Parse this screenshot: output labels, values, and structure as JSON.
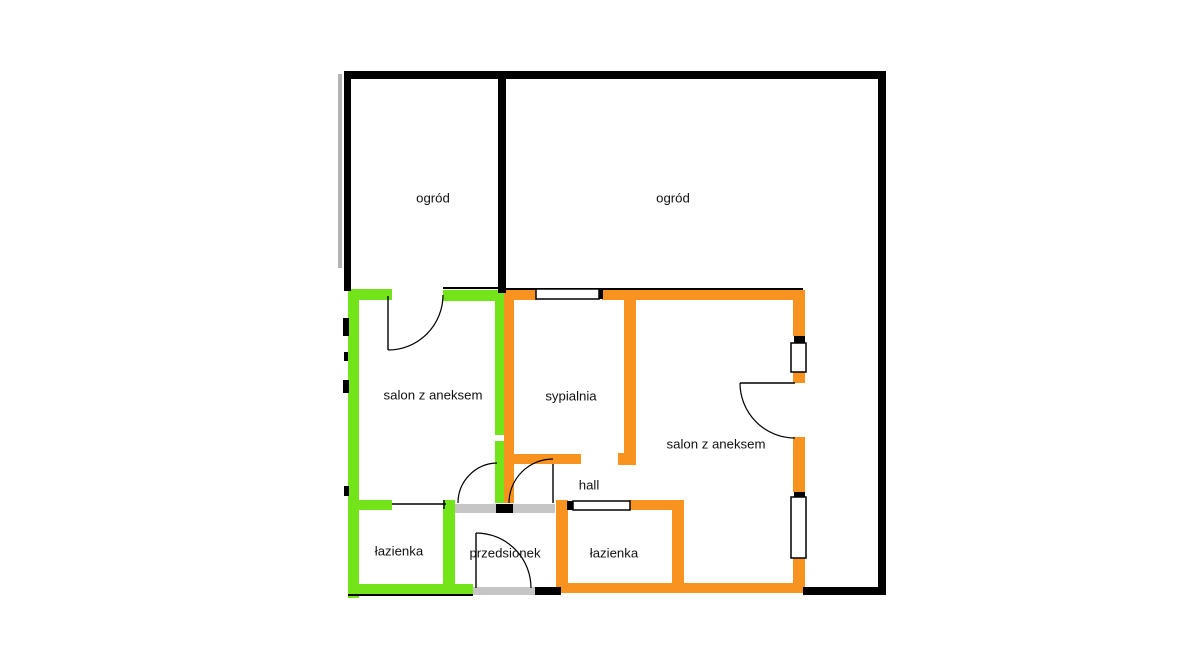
{
  "page": {
    "title": "Floor plan of two apartments with gardens",
    "background": "#ffffff"
  },
  "plan": {
    "width": 1191,
    "height": 667,
    "colors": {
      "black": "#000000",
      "green": "#74e41a",
      "orange": "#f7931e",
      "gray": "#c6c6c6",
      "shadow": "#b3b3b3",
      "window_fill": "#ffffff",
      "line": "#000000",
      "label": "#111111"
    },
    "label_font_size": 13.2,
    "shadows": [
      {
        "name": "left-outer-shadow",
        "x": 338,
        "y": 74,
        "w": 4,
        "h": 194
      }
    ],
    "walls_gray": [
      {
        "name": "entry-top-wall",
        "x": 455,
        "y": 504,
        "w": 100,
        "h": 9
      },
      {
        "name": "entry-bottom-threshold",
        "x": 473,
        "y": 587,
        "w": 62,
        "h": 8
      }
    ],
    "walls_green": [
      {
        "name": "green-left-wall",
        "x": 348,
        "y": 289,
        "w": 11,
        "h": 309
      },
      {
        "name": "green-top-wall-1",
        "x": 348,
        "y": 289,
        "w": 44,
        "h": 11
      },
      {
        "name": "green-top-wall-2",
        "x": 443,
        "y": 290,
        "w": 58,
        "h": 11
      },
      {
        "name": "green-salon-right-wall-upper",
        "x": 495,
        "y": 291,
        "w": 10,
        "h": 144
      },
      {
        "name": "green-salon-right-wall-lower",
        "x": 495,
        "y": 441,
        "w": 10,
        "h": 62
      },
      {
        "name": "green-bathroom-top-wall",
        "x": 348,
        "y": 500,
        "w": 44,
        "h": 10
      },
      {
        "name": "green-bathroom-right-wall",
        "x": 443,
        "y": 500,
        "w": 12,
        "h": 93
      },
      {
        "name": "green-bottom-wall",
        "x": 348,
        "y": 584,
        "w": 125,
        "h": 10
      }
    ],
    "walls_orange": [
      {
        "name": "orange-bedroom-left-wall",
        "x": 504,
        "y": 291,
        "w": 10,
        "h": 212
      },
      {
        "name": "orange-top-wall-1",
        "x": 504,
        "y": 290,
        "w": 33,
        "h": 10
      },
      {
        "name": "orange-top-wall-2",
        "x": 602,
        "y": 290,
        "w": 203,
        "h": 10
      },
      {
        "name": "orange-right-wall-1",
        "x": 793,
        "y": 291,
        "w": 12,
        "h": 45
      },
      {
        "name": "orange-right-wall-2",
        "x": 793,
        "y": 372,
        "w": 12,
        "h": 11
      },
      {
        "name": "orange-right-wall-3",
        "x": 793,
        "y": 437,
        "w": 12,
        "h": 55
      },
      {
        "name": "orange-right-wall-4",
        "x": 793,
        "y": 558,
        "w": 12,
        "h": 35
      },
      {
        "name": "orange-bottom-wall",
        "x": 557,
        "y": 583,
        "w": 246,
        "h": 10
      },
      {
        "name": "orange-bedroom-right-wall",
        "x": 624,
        "y": 291,
        "w": 12,
        "h": 174
      },
      {
        "name": "orange-bedroom-right-wall-foot",
        "x": 618,
        "y": 453,
        "w": 18,
        "h": 12
      },
      {
        "name": "orange-bedroom-bottom-wall",
        "x": 504,
        "y": 454,
        "w": 77,
        "h": 10
      },
      {
        "name": "orange-bathroom-left-wall",
        "x": 556,
        "y": 500,
        "w": 12,
        "h": 93
      },
      {
        "name": "orange-bathroom-top-wall",
        "x": 628,
        "y": 500,
        "w": 56,
        "h": 10
      },
      {
        "name": "orange-bathroom-right-wall",
        "x": 672,
        "y": 500,
        "w": 12,
        "h": 90
      }
    ],
    "walls_black": [
      {
        "name": "outer-top-wall",
        "x": 345,
        "y": 71,
        "w": 541,
        "h": 8
      },
      {
        "name": "outer-left-wall",
        "x": 344,
        "y": 71,
        "w": 7,
        "h": 220
      },
      {
        "name": "outer-right-wall",
        "x": 878,
        "y": 71,
        "w": 8,
        "h": 524
      },
      {
        "name": "outer-bottom-right-wall",
        "x": 803,
        "y": 587,
        "w": 83,
        "h": 8
      },
      {
        "name": "garden-divider-wall",
        "x": 498,
        "y": 71,
        "w": 8,
        "h": 222
      },
      {
        "name": "left-wall-tick-1",
        "x": 343,
        "y": 318,
        "w": 6,
        "h": 18
      },
      {
        "name": "left-wall-tick-2",
        "x": 344,
        "y": 352,
        "w": 4,
        "h": 9
      },
      {
        "name": "left-wall-tick-3",
        "x": 343,
        "y": 380,
        "w": 6,
        "h": 13
      },
      {
        "name": "left-wall-tick-4",
        "x": 344,
        "y": 486,
        "w": 5,
        "h": 10
      },
      {
        "name": "entry-wall-stub-top",
        "x": 496,
        "y": 504,
        "w": 17,
        "h": 9
      },
      {
        "name": "entry-wall-stub-bottom",
        "x": 535,
        "y": 587,
        "w": 26,
        "h": 8
      },
      {
        "name": "window-tick-bedroom",
        "x": 598,
        "y": 290,
        "w": 5,
        "h": 9
      },
      {
        "name": "window-tick-hall",
        "x": 567,
        "y": 501,
        "w": 7,
        "h": 9
      },
      {
        "name": "window-tick-right-1",
        "x": 794,
        "y": 336,
        "w": 11,
        "h": 7
      },
      {
        "name": "window-tick-right-2",
        "x": 794,
        "y": 492,
        "w": 11,
        "h": 5
      },
      {
        "name": "wall-underlay-line-top",
        "x": 506,
        "y": 288,
        "w": 297,
        "h": 2
      },
      {
        "name": "wall-underlay-line-green-top",
        "x": 443,
        "y": 287,
        "w": 57,
        "h": 2
      },
      {
        "name": "wall-underlay-line-green-bottom",
        "x": 348,
        "y": 594,
        "w": 125,
        "h": 2
      }
    ],
    "windows": [
      {
        "name": "window-bedroom-top",
        "x": 536,
        "y": 289,
        "w": 63,
        "h": 10
      },
      {
        "name": "window-right-upper",
        "x": 791,
        "y": 343,
        "w": 15,
        "h": 29
      },
      {
        "name": "window-right-lower",
        "x": 791,
        "y": 497,
        "w": 15,
        "h": 61
      },
      {
        "name": "window-hall",
        "x": 573,
        "y": 501,
        "w": 57,
        "h": 9
      }
    ],
    "door_leaves": [
      {
        "name": "door-leaf-garden-green",
        "d": "M388,296 L388,350"
      },
      {
        "name": "door-leaf-hall",
        "d": "M553,464 L553,503"
      },
      {
        "name": "door-leaf-entry",
        "d": "M476,533 L476,588"
      },
      {
        "name": "door-leaf-salon-orange",
        "d": "M740,383 L795,383"
      },
      {
        "name": "door-line-green-bathroom",
        "d": "M392,504 L446,504"
      },
      {
        "name": "door-tick-green-bathroom",
        "d": "M444,500 L444,509"
      }
    ],
    "door_arcs": [
      {
        "name": "door-arc-garden-green",
        "d": "M388,350 A55,55 0 0 0 443,295"
      },
      {
        "name": "door-arc-green-salon",
        "d": "M458,503 A40,40 0 0 1 497,463"
      },
      {
        "name": "door-arc-hall",
        "d": "M509,503 A44,44 0 0 1 553,459"
      },
      {
        "name": "door-arc-entry",
        "d": "M476,533 A55,55 0 0 1 531,588"
      },
      {
        "name": "door-arc-salon-orange",
        "d": "M740,383 A55,55 0 0 0 795,438"
      }
    ],
    "labels": [
      {
        "name": "label-garden-left",
        "text": "ogród",
        "x": 433,
        "y": 198
      },
      {
        "name": "label-garden-right",
        "text": "ogród",
        "x": 673,
        "y": 198
      },
      {
        "name": "label-salon-green",
        "text": "salon z aneksem",
        "x": 433,
        "y": 395
      },
      {
        "name": "label-bedroom",
        "text": "sypialnia",
        "x": 571,
        "y": 396
      },
      {
        "name": "label-salon-orange",
        "text": "salon z aneksem",
        "x": 716,
        "y": 444
      },
      {
        "name": "label-hall",
        "text": "hall",
        "x": 589,
        "y": 485
      },
      {
        "name": "label-bathroom-green",
        "text": "łazienka",
        "x": 399,
        "y": 551
      },
      {
        "name": "label-entry",
        "text": "przedsionek",
        "x": 505,
        "y": 553
      },
      {
        "name": "label-bathroom-orange",
        "text": "łazienka",
        "x": 614,
        "y": 553
      }
    ]
  }
}
